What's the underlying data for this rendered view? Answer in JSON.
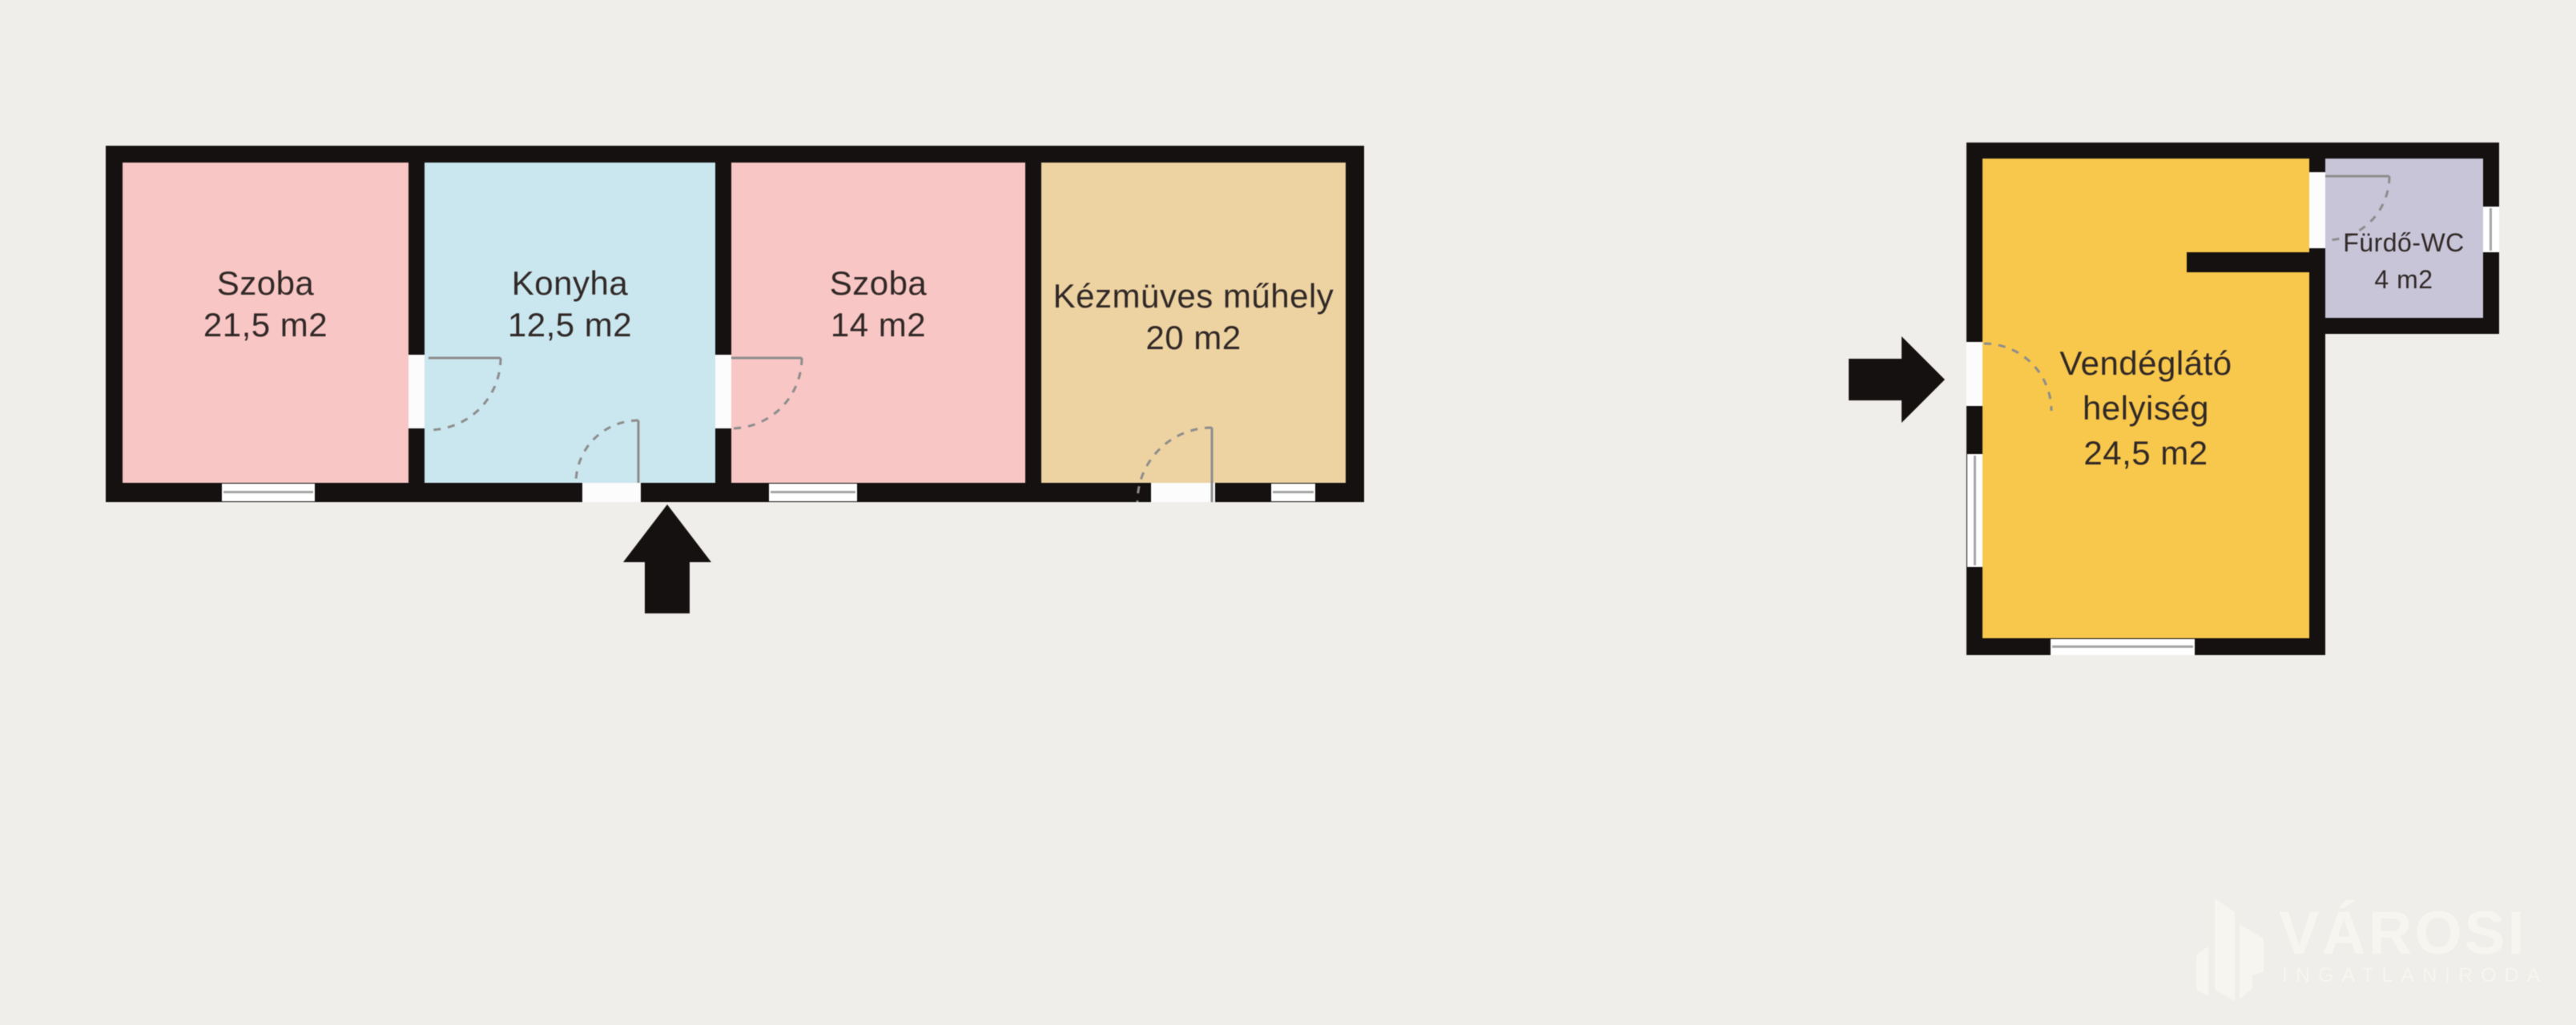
{
  "canvas": {
    "background": "#efeeea"
  },
  "plan": {
    "building_left": {
      "rooms": [
        {
          "name": "Szoba",
          "area": "21,5 m2",
          "color": "#f8c6c4"
        },
        {
          "name": "Konyha",
          "area": "12,5 m2",
          "color": "#cae6ee"
        },
        {
          "name": "Szoba",
          "area": "14 m2",
          "color": "#f8c6c4"
        },
        {
          "name": "Kézmüves műhely",
          "area": "20 m2",
          "color": "#edd2a2"
        }
      ]
    },
    "building_right": {
      "rooms": [
        {
          "name": "Vendéglátó",
          "name_line2": "helyiség",
          "area": "24,5 m2",
          "color": "#f8c84c"
        },
        {
          "name": "Fürdő-WC",
          "area": "4 m2",
          "color": "#c8c5d8"
        }
      ]
    },
    "wall_color": "#141110",
    "label_color": "#312927",
    "icons": {
      "entrance_arrow_up": "up-arrow",
      "entrance_arrow_right": "right-arrow"
    }
  },
  "watermark": {
    "brand": "VÁROSI",
    "subtitle": "INGATLANIRODA",
    "color": "#f7f5f0"
  }
}
